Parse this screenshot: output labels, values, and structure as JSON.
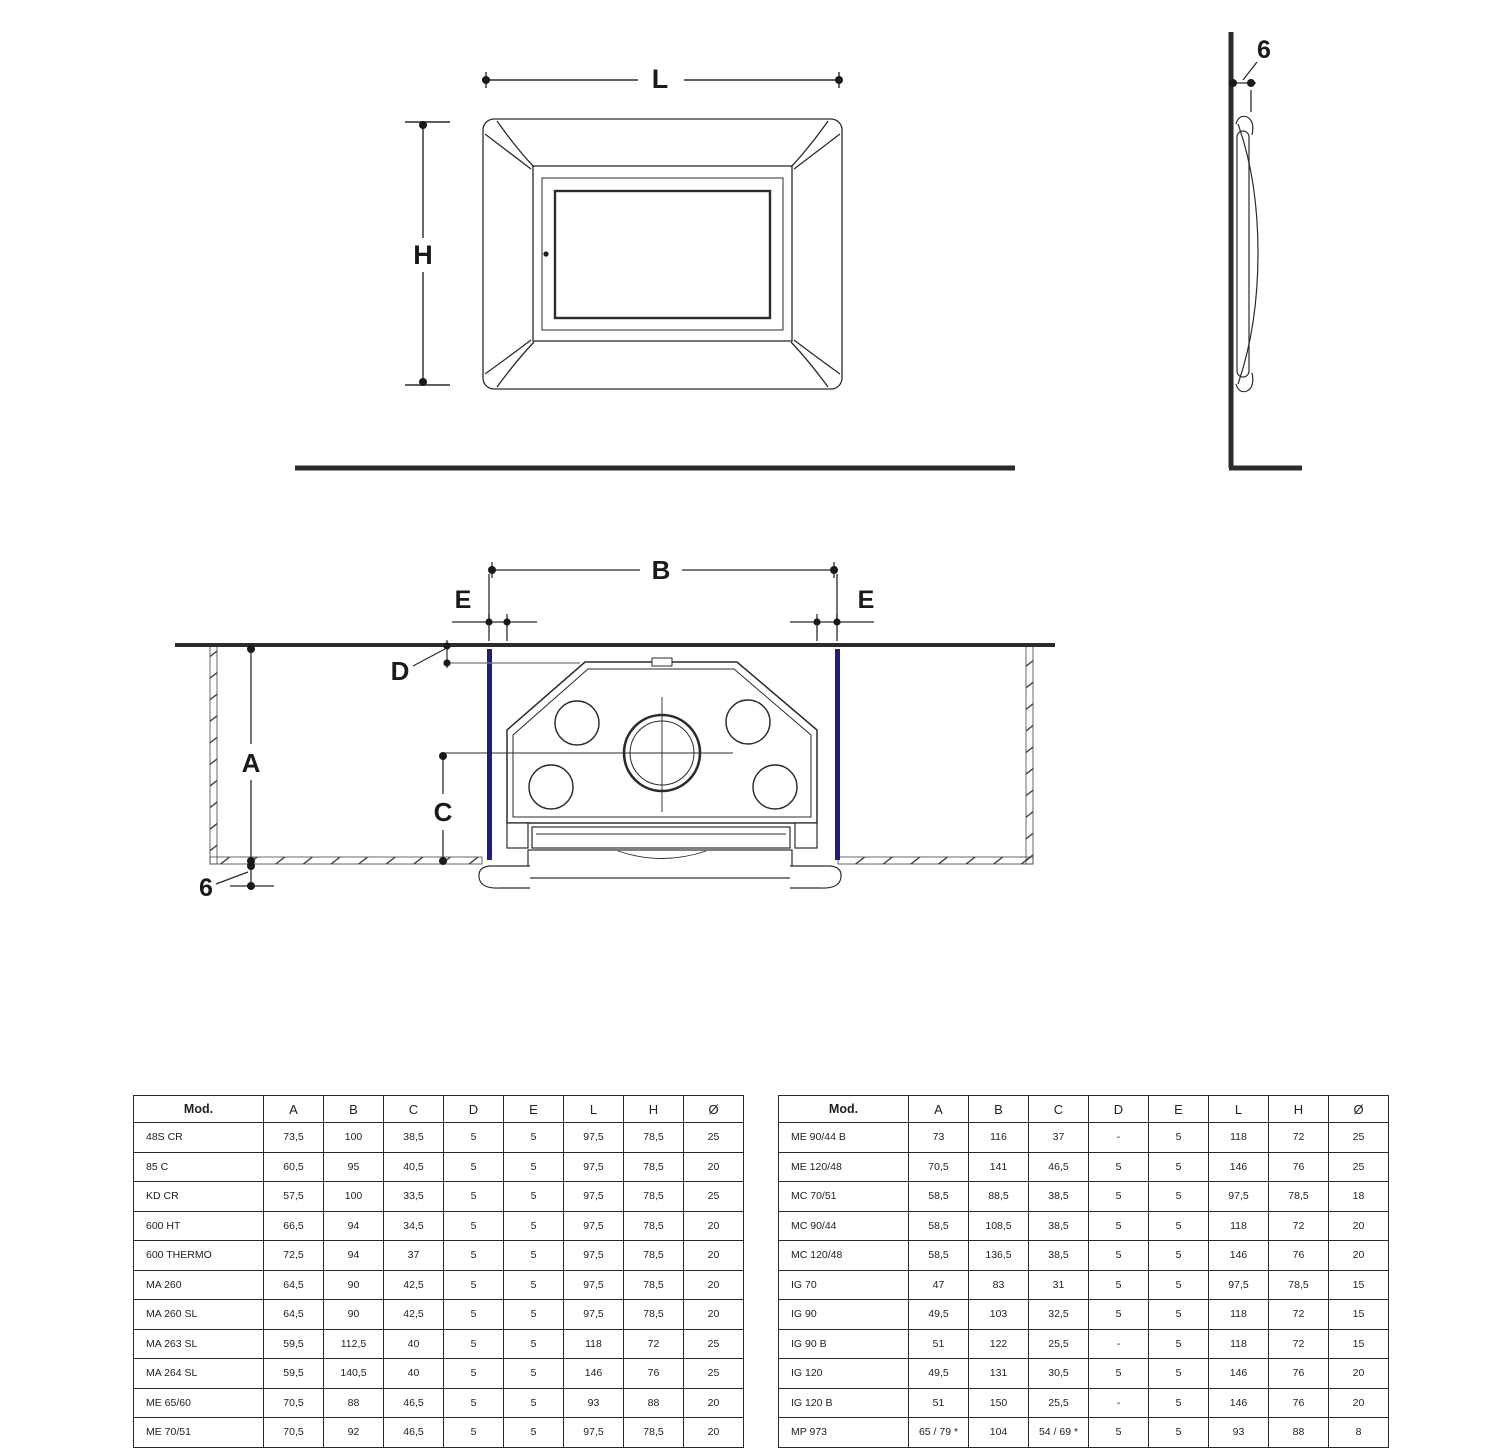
{
  "labels": {
    "front_view": {
      "width": "L",
      "height": "H"
    },
    "side_view": {
      "frame_depth": "6"
    },
    "section_view": {
      "recess_width": "B",
      "gap_left": "E",
      "gap_right": "E",
      "offset_front": "D",
      "recess_depth": "A",
      "center_depth": "C",
      "floor_gap": "6"
    }
  },
  "colors": {
    "annotation_blue": "#1e1e7d",
    "drawing_line": "#2b2b2b"
  },
  "tables": {
    "headers": [
      "Mod.",
      "A",
      "B",
      "C",
      "D",
      "E",
      "L",
      "H",
      "Ø"
    ],
    "left_rows": [
      [
        "48S CR",
        "73,5",
        "100",
        "38,5",
        "5",
        "5",
        "97,5",
        "78,5",
        "25"
      ],
      [
        "85 C",
        "60,5",
        "95",
        "40,5",
        "5",
        "5",
        "97,5",
        "78,5",
        "20"
      ],
      [
        "KD CR",
        "57,5",
        "100",
        "33,5",
        "5",
        "5",
        "97,5",
        "78,5",
        "25"
      ],
      [
        "600 HT",
        "66,5",
        "94",
        "34,5",
        "5",
        "5",
        "97,5",
        "78,5",
        "20"
      ],
      [
        "600 THERMO",
        "72,5",
        "94",
        "37",
        "5",
        "5",
        "97,5",
        "78,5",
        "20"
      ],
      [
        "MA 260",
        "64,5",
        "90",
        "42,5",
        "5",
        "5",
        "97,5",
        "78,5",
        "20"
      ],
      [
        "MA 260 SL",
        "64,5",
        "90",
        "42,5",
        "5",
        "5",
        "97,5",
        "78,5",
        "20"
      ],
      [
        "MA 263 SL",
        "59,5",
        "112,5",
        "40",
        "5",
        "5",
        "118",
        "72",
        "25"
      ],
      [
        "MA 264 SL",
        "59,5",
        "140,5",
        "40",
        "5",
        "5",
        "146",
        "76",
        "25"
      ],
      [
        "ME 65/60",
        "70,5",
        "88",
        "46,5",
        "5",
        "5",
        "93",
        "88",
        "20"
      ],
      [
        "ME 70/51",
        "70,5",
        "92",
        "46,5",
        "5",
        "5",
        "97,5",
        "78,5",
        "20"
      ]
    ],
    "right_rows": [
      [
        "ME 90/44 B",
        "73",
        "116",
        "37",
        "-",
        "5",
        "118",
        "72",
        "25"
      ],
      [
        "ME 120/48",
        "70,5",
        "141",
        "46,5",
        "5",
        "5",
        "146",
        "76",
        "25"
      ],
      [
        "MC 70/51",
        "58,5",
        "88,5",
        "38,5",
        "5",
        "5",
        "97,5",
        "78,5",
        "18"
      ],
      [
        "MC 90/44",
        "58,5",
        "108,5",
        "38,5",
        "5",
        "5",
        "118",
        "72",
        "20"
      ],
      [
        "MC 120/48",
        "58,5",
        "136,5",
        "38,5",
        "5",
        "5",
        "146",
        "76",
        "20"
      ],
      [
        "IG 70",
        "47",
        "83",
        "31",
        "5",
        "5",
        "97,5",
        "78,5",
        "15"
      ],
      [
        "IG 90",
        "49,5",
        "103",
        "32,5",
        "5",
        "5",
        "118",
        "72",
        "15"
      ],
      [
        "IG 90 B",
        "51",
        "122",
        "25,5",
        "-",
        "5",
        "118",
        "72",
        "15"
      ],
      [
        "IG 120",
        "49,5",
        "131",
        "30,5",
        "5",
        "5",
        "146",
        "76",
        "20"
      ],
      [
        "IG 120 B",
        "51",
        "150",
        "25,5",
        "-",
        "5",
        "146",
        "76",
        "20"
      ],
      [
        "MP 973",
        "65 / 79 *",
        "104",
        "54 / 69 *",
        "5",
        "5",
        "93",
        "88",
        "8"
      ]
    ]
  }
}
